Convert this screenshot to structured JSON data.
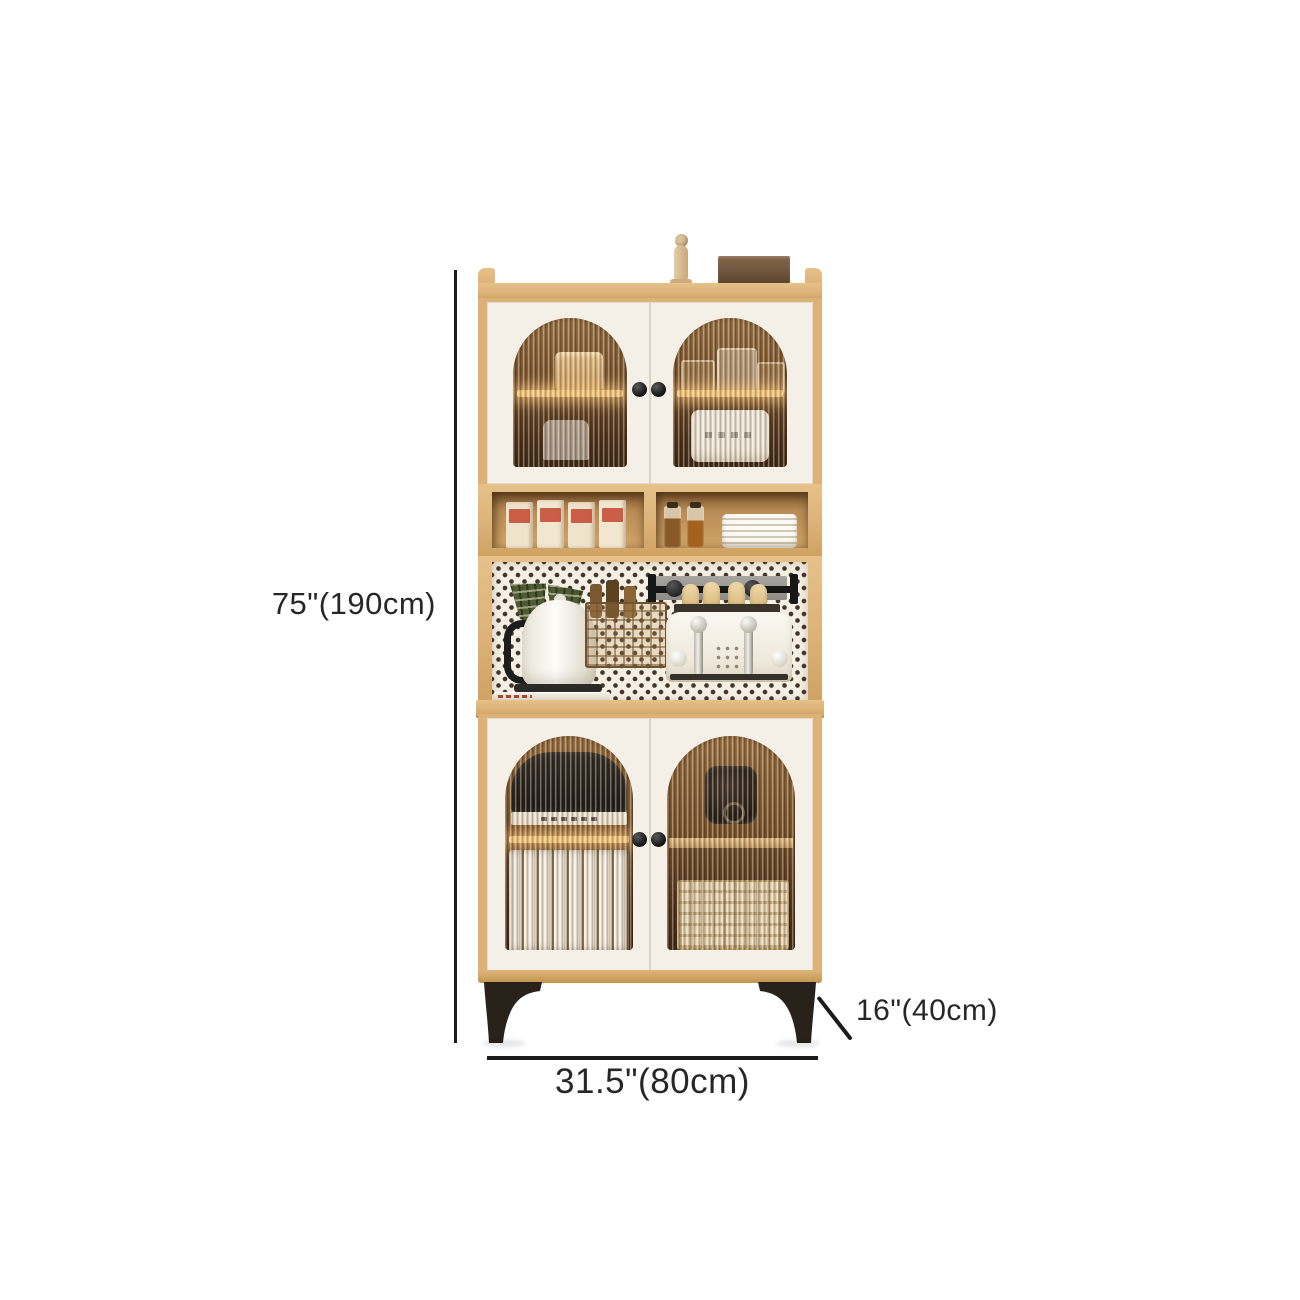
{
  "meta": {
    "type": "product-dimension-diagram",
    "subject": "kitchen-sideboard-hutch-cabinet",
    "background_color": "#ffffff"
  },
  "annotations": {
    "height_label": "75\"(190cm)",
    "width_label": "31.5\"(80cm)",
    "depth_label": "16\"(40cm)",
    "line_color": "#1c1c1c",
    "text_color": "#272727"
  },
  "style_colors": {
    "wood_frame": "#dcb278",
    "door_panel": "#f4f0e7",
    "cabinet_interior": "#6e4923",
    "shelf_light_glow": "#f9c97e",
    "pegboard": "#f4f0e3",
    "pegboard_dots": "#45342a",
    "legs": "#29221b",
    "box_label_red": "#c4452f",
    "towel_green": "#4d5a33"
  }
}
